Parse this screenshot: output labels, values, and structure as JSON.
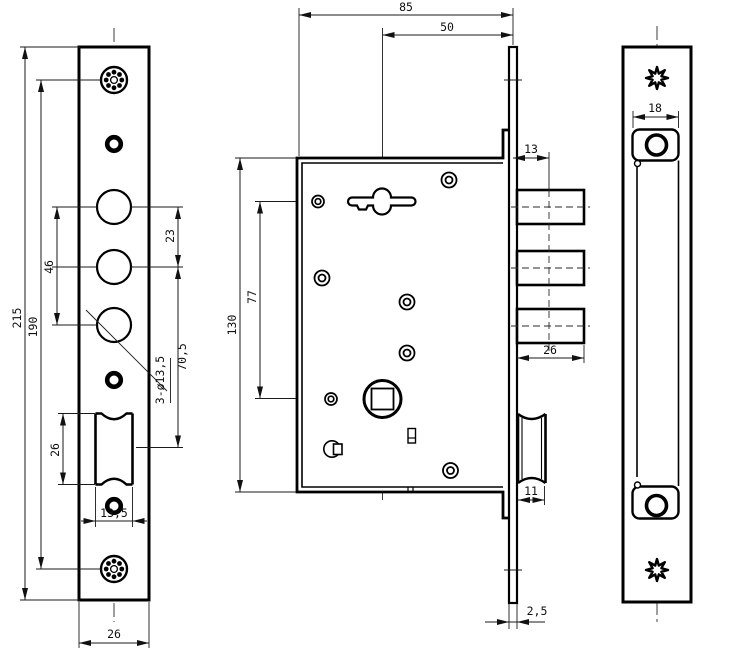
{
  "colors": {
    "ink": "#000000",
    "background": "#ffffff",
    "dimension": "#1a1a1a"
  },
  "views": {
    "faceplate_front": {
      "dims": {
        "overall_height": "215",
        "screw_centers": "190",
        "hole_span_outer": "46",
        "hole_span_inner": "23",
        "latch_center_offset": "70,5",
        "hole_callout": "3-ø13,5",
        "latch_cutout_height": "26",
        "latch_cutout_width": "13,5",
        "plate_width": "26"
      }
    },
    "lock_body_side": {
      "dims": {
        "body_depth": "85",
        "backset": "50",
        "bolt_offset": "13",
        "bolt_length": "26",
        "key_to_spindle": "77",
        "body_height": "130",
        "latch_projection": "11",
        "faceplate_thickness": "2,5"
      }
    },
    "strike_plate": {
      "dims": {
        "slot_width": "18"
      }
    }
  }
}
